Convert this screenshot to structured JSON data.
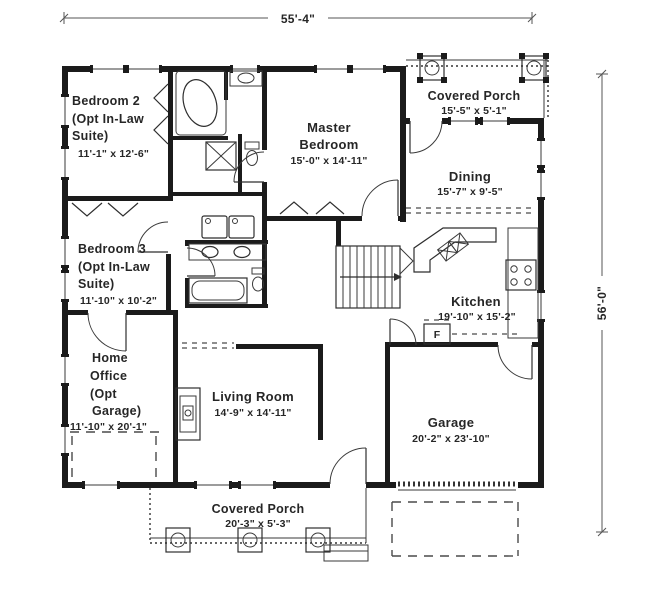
{
  "colors": {
    "ink": "#1b1b1b",
    "background": "#ffffff"
  },
  "dimensions": {
    "overall_width": "55'-4\"",
    "overall_height": "56'-0\""
  },
  "rooms": {
    "bedroom2": {
      "name": "Bedroom 2",
      "opt1": "(Opt In-Law",
      "opt2": "Suite)",
      "dims": "11'-1\" x 12'-6\""
    },
    "master_bedroom": {
      "name1": "Master",
      "name2": "Bedroom",
      "dims": "15'-0\" x 14'-11\""
    },
    "covered_porch_top": {
      "name": "Covered Porch",
      "dims": "15'-5\" x 5'-1\""
    },
    "dining": {
      "name": "Dining",
      "dims": "15'-7\" x 9'-5\""
    },
    "bedroom3": {
      "name": "Bedroom 3",
      "opt1": "(Opt In-Law",
      "opt2": "Suite)",
      "dims": "11'-10\" x 10'-2\""
    },
    "kitchen": {
      "name": "Kitchen",
      "dims": "19'-10\" x 15'-2\"",
      "fridge": "F"
    },
    "home_office": {
      "name1": "Home",
      "name2": "Office",
      "opt1": "(Opt",
      "opt2": "Garage)",
      "dims": "11'-10\" x 20'-1\""
    },
    "living_room": {
      "name": "Living Room",
      "dims": "14'-9\" x 14'-11\""
    },
    "garage": {
      "name": "Garage",
      "dims": "20'-2\" x 23'-10\""
    },
    "covered_porch_bottom": {
      "name": "Covered Porch",
      "dims": "20'-3\" x 5'-3\""
    }
  }
}
